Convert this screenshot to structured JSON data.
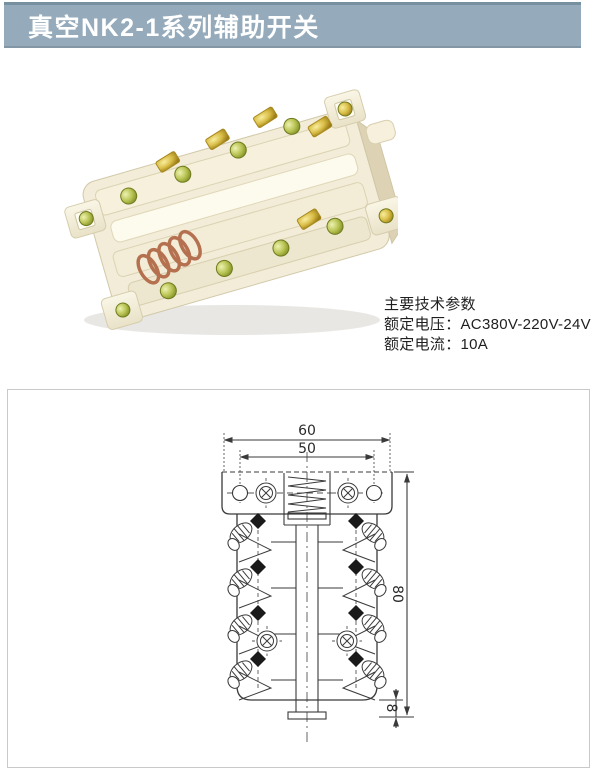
{
  "header": {
    "title": "真空NK2-1系列辅助开关",
    "colors": {
      "bar_bg": "#95abbc",
      "bar_top_edge": "#76909f",
      "bar_bottom_edge": "#8296a6",
      "text": "#ffffff"
    }
  },
  "specs": {
    "heading": "主要技术参数",
    "rated_voltage_line": "额定电压：AC380V-220V-24V",
    "rated_current_line": "额定电流：10A"
  },
  "photo": {
    "colors": {
      "plastic": "#f2ecd8",
      "plastic_shade": "#ddd3b4",
      "brass": "#c9a227",
      "green_screw": "#9fae3a",
      "copper_spring": "#b5714f"
    }
  },
  "diagram": {
    "dimensions": {
      "overall_width": "60",
      "hole_spacing": "50",
      "overall_height": "80",
      "shaft_extension": "8"
    },
    "line_color": "#3a3a3a",
    "border_color": "#c9c9c9"
  }
}
